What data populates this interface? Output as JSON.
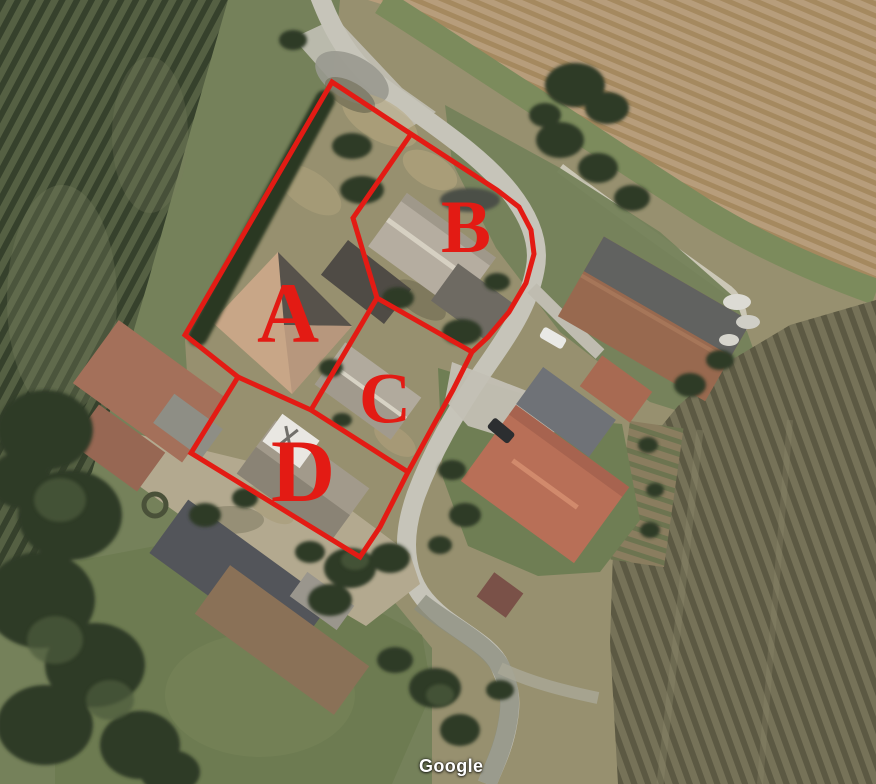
{
  "canvas": {
    "width": 876,
    "height": 784
  },
  "watermark": {
    "label": "Google"
  },
  "parcels": [
    {
      "id": "A",
      "label": "A",
      "label_pos": {
        "x": 288,
        "y": 318
      },
      "font_size": 86
    },
    {
      "id": "B",
      "label": "B",
      "label_pos": {
        "x": 466,
        "y": 232
      },
      "font_size": 75
    },
    {
      "id": "C",
      "label": "C",
      "label_pos": {
        "x": 385,
        "y": 403
      },
      "font_size": 72
    },
    {
      "id": "D",
      "label": "D",
      "label_pos": {
        "x": 303,
        "y": 478
      },
      "font_size": 89
    }
  ],
  "overlay": {
    "color": "#e31b14",
    "stroke_width": 5,
    "lines": [
      {
        "name": "outer-boundary",
        "closed": true,
        "points": "332,82 411,134 497,190 519,207 531,230 534,254 526,283 509,312 488,337 472,352 453,390 432,428 408,472 380,527 360,557 191,453 238,377 185,335"
      },
      {
        "name": "divider-a-b",
        "closed": false,
        "points": "411,134 353,218 377,298"
      },
      {
        "name": "divider-b-c",
        "closed": false,
        "points": "377,298 472,352"
      },
      {
        "name": "divider-a-c",
        "closed": false,
        "points": "377,298 311,410"
      },
      {
        "name": "divider-a-d",
        "closed": false,
        "points": "238,377 311,410"
      },
      {
        "name": "divider-c-d",
        "closed": false,
        "points": "311,410 408,472"
      }
    ]
  },
  "palette": {
    "boundary_red": "#e31b14",
    "road_gray": "#c6c4b9",
    "scrub": "#97906f",
    "grass": "#75815a",
    "plowed_field": "#b79d7b",
    "dark_field": "#767258",
    "tree_green": "#2e3a26",
    "tile_roof": "#b86f57"
  }
}
